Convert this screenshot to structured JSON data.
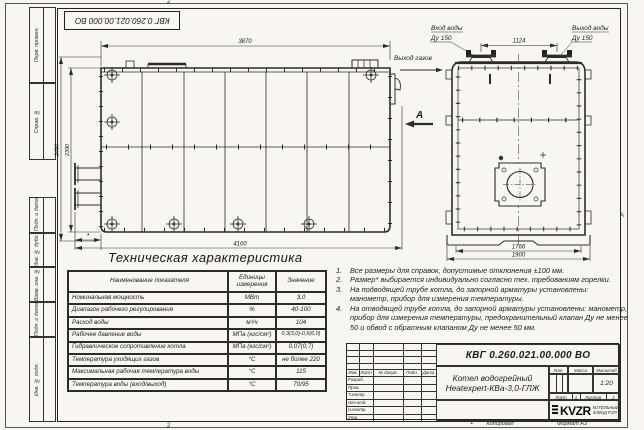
{
  "zones": {
    "top": "2",
    "bottom_left": "2",
    "bottom_mid": "1",
    "right": "А"
  },
  "corner_doc": "КВГ 0.260.021.00.000 ВО",
  "margin": {
    "boxes": [
      "Перв. примен.",
      "Справ. №",
      "Подп. и дата",
      "Инв. № дубл.",
      "Взам. инв. №",
      "Подп. и дата",
      "Инв. № подл."
    ]
  },
  "drawing": {
    "dims": {
      "width_top": "3870",
      "height_outer": "2480",
      "height_body": "2390",
      "length_bottom": "4100",
      "star": "*",
      "flange_span": "1124",
      "front_inner": "1766",
      "front_outer": "1900"
    },
    "labels": {
      "water_in_1": "Вход воды",
      "water_in_2": "Ду 150",
      "water_out_1": "Выход воды",
      "water_out_2": "Ду 150",
      "gas_out": "Выход газов",
      "view_mark": "А"
    }
  },
  "table": {
    "title": "Техническая характеристика",
    "col_name": "Наименование показателя",
    "col_unit": "Единицы измерения",
    "col_value": "Значение",
    "rows": [
      {
        "name": "Номинальная мощность",
        "unit": "МВт",
        "value": "3,0"
      },
      {
        "name": "Диапазон рабочего регулирования",
        "unit": "%",
        "value": "40-100"
      },
      {
        "name": "Расход воды",
        "unit": "м³/ч",
        "value": "104"
      },
      {
        "name": "Рабочее давление воды",
        "unit": "МПа (кгс/см²)",
        "value": "0,3(3,0)-0,6(6,0)"
      },
      {
        "name": "Гидравлическое сопротивление котла",
        "unit": "МПа (кгс/см²)",
        "value": "0,07(0,7)"
      },
      {
        "name": "Температура уходящих газов",
        "unit": "°С",
        "value": "не более 220"
      },
      {
        "name": "Максимальная рабочая температура воды",
        "unit": "°С",
        "value": "115"
      },
      {
        "name": "Температура воды (вход/выход)",
        "unit": "°С",
        "value": "70/95"
      }
    ]
  },
  "notes": {
    "items": [
      {
        "num": "1.",
        "text": "Все размеры для справок, допустимые отклонения ±100 мм."
      },
      {
        "num": "2.",
        "text": "Размер* выбирается индивидуально согласно тех. требованиям горелки."
      },
      {
        "num": "3.",
        "text": "На подводящей трубе котла, до запорной арматуры установлены: манометр, прибор для измерения температуры."
      },
      {
        "num": "4.",
        "text": "На отводящей трубе котла, до запорной арматуры установлены: манометр, прибор для измерения температуры, предохранительный клапан Ду не менее 50 и обвод с обратным клапаном Ду не менее 50 мм."
      }
    ]
  },
  "stamp": {
    "doc_number": "КВГ 0.260.021.00.000 ВО",
    "product_line1": "Котел водогрейный",
    "product_line2": "Heatexpert-КВа-3,0-ГЛЖ",
    "cols": [
      "Изм.",
      "Лист",
      "№ докум.",
      "Подп.",
      "Дата"
    ],
    "rows": [
      "Разраб.",
      "Пров.",
      "Т.контр.",
      "Нач.отд.",
      "Н.контр.",
      "Утв."
    ],
    "lit_label": "Лит.",
    "mass_label": "Масса",
    "scale_label": "Масштаб",
    "scale": "1:20",
    "sheet_label": "Лист",
    "sheet": "1",
    "sheets_label": "Листов",
    "sheets": "2",
    "logo": "KVZR",
    "company_line1": "КОТЕЛЬНЫЙ",
    "company_line2": "ЗАВОД РЭП",
    "copied": "Копировал",
    "format": "Формат А3"
  }
}
